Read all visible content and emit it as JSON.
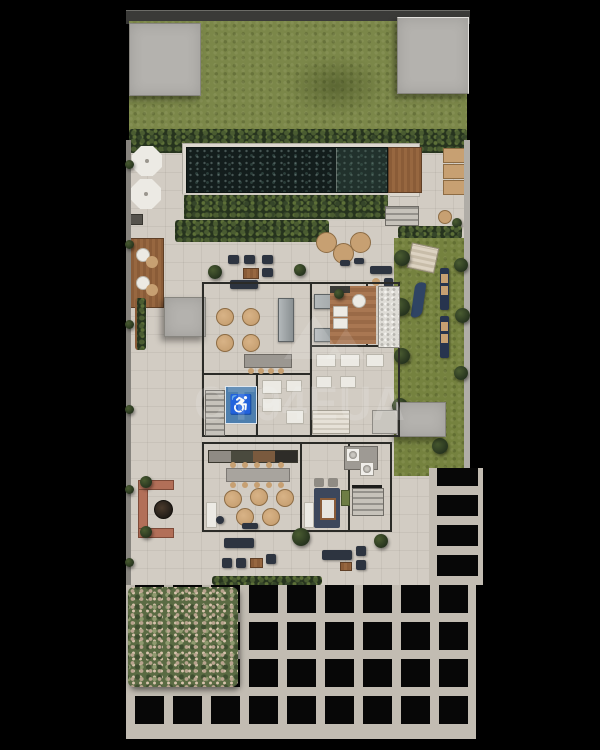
{
  "scene": {
    "kind": "architectural site plan render, top-down view",
    "areas": [
      "rooftop slabs",
      "lawn",
      "hedge rows",
      "swimming pool",
      "wood deck",
      "sun mats",
      "umbrella lounge",
      "outdoor dining",
      "party room",
      "kitchen",
      "gourmet room",
      "accessible restroom",
      "sauna",
      "laundry",
      "games room",
      "coworking tables",
      "kids garden",
      "loungers",
      "fire-pit planter",
      "pergola grid",
      "shrub patch"
    ]
  },
  "watermark": {
    "text": "CT94EUA",
    "logo": "roof-triangles"
  },
  "icons": {
    "accessible_glyph": "♿"
  },
  "palette": {
    "bg": "#000000",
    "concrete": "#d2ccc3",
    "concrete_light": "#dcd7ce",
    "slab": "#b4b2ae",
    "roof": "#3a3a38",
    "lawn": "#7b8749",
    "hedge": "#26331e",
    "hedge_leaf": "#4a5c31",
    "water": "#131d1c",
    "wood": "#8a5c38",
    "wood_light": "#a97752",
    "navy": "#2d3440",
    "tan": "#c7a072",
    "white_item": "#eceae4",
    "brick": "#b26f58",
    "beam": "#c2bcb2",
    "grid_dark": "#070707",
    "wall": "#2b2b27",
    "blue_access": "#4e7fae"
  }
}
